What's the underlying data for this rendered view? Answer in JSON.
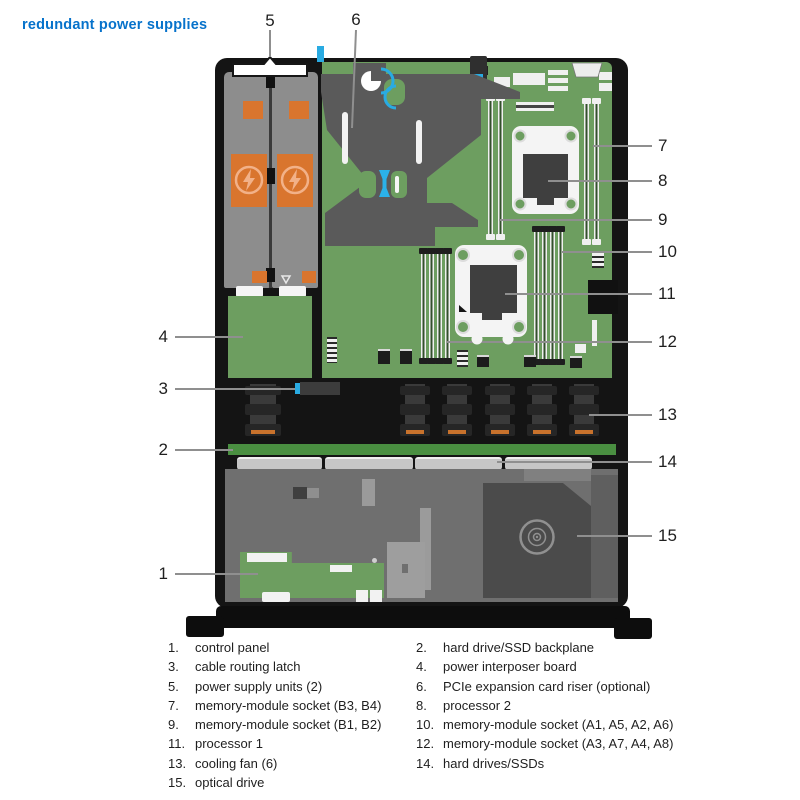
{
  "title": "redundant power supplies",
  "callout_numbers": [
    "1",
    "2",
    "3",
    "4",
    "5",
    "6",
    "7",
    "8",
    "9",
    "10",
    "11",
    "12",
    "13",
    "14",
    "15"
  ],
  "legend": {
    "left": [
      {
        "num": "1.",
        "text": "control panel"
      },
      {
        "num": "3.",
        "text": "cable routing latch"
      },
      {
        "num": "5.",
        "text": "power supply units (2)"
      },
      {
        "num": "7.",
        "text": "memory-module socket (B3, B4)"
      },
      {
        "num": "9.",
        "text": "memory-module socket (B1, B2)"
      },
      {
        "num": "11.",
        "text": "processor 1"
      },
      {
        "num": "13.",
        "text": "cooling fan (6)"
      },
      {
        "num": "15.",
        "text": "optical drive"
      }
    ],
    "right": [
      {
        "num": "2.",
        "text": "hard drive/SSD backplane"
      },
      {
        "num": "4.",
        "text": "power interposer board"
      },
      {
        "num": "6.",
        "text": "PCIe expansion card riser (optional)"
      },
      {
        "num": "8.",
        "text": "processor 2"
      },
      {
        "num": "10.",
        "text": "memory-module socket (A1, A5, A2, A6)"
      },
      {
        "num": "12.",
        "text": "memory-module socket (A3, A7, A4, A8)"
      },
      {
        "num": "14.",
        "text": "hard drives/SSDs"
      }
    ]
  },
  "colors": {
    "title_blue": "#0672CB",
    "accent_blue": "#29ABE2",
    "board_green": "#6D9E60",
    "backplane_green": "#4A8F41",
    "psu_orange": "#D9752E",
    "psu_gray": "#8D8D8D",
    "chassis_black": "#141414",
    "riser_gray": "#5A5A5A"
  }
}
